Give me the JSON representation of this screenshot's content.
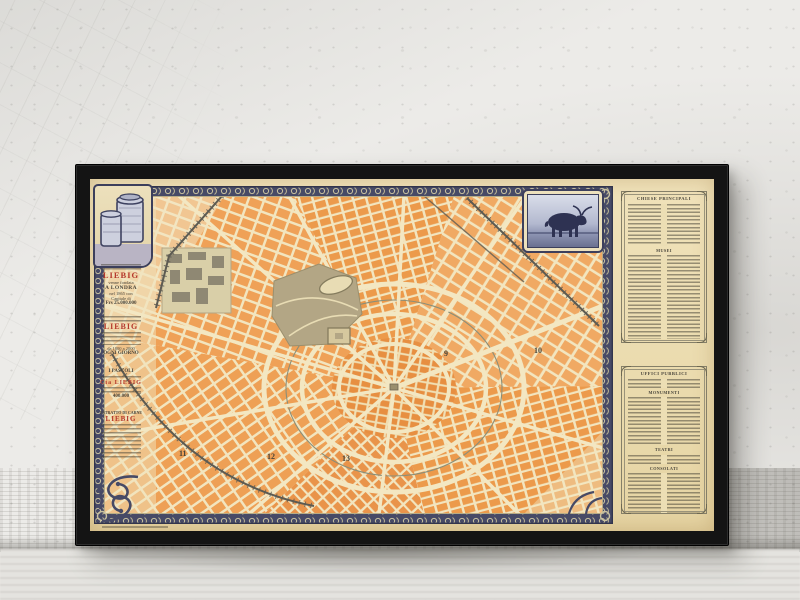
{
  "colors": {
    "wall": "#ecebe8",
    "frame": "#141414",
    "sheet": "#eadcb2",
    "map_cream": "#f2e5bf",
    "block_orange": "#efa157",
    "block_orange_dark": "#e78f41",
    "border_indigo": "#474a66",
    "accent_red": "#b5392c",
    "park_green": "#b3a685"
  },
  "map": {
    "district_numbers": [
      "9",
      "10",
      "11",
      "12",
      "13"
    ],
    "ads": {
      "block1": {
        "brand": "LIEBIG",
        "line1": "venne fondata",
        "line2": "A LONDRA",
        "line3": "nel 1865 con",
        "line4": "Capitale di",
        "line5": "Frs 25.000.000"
      },
      "block2": {
        "brand": "LIEBIG",
        "line1": "da 1800 a 2000",
        "footer": "OGNI GIORNO"
      },
      "block3": {
        "title": "I PASCOLI",
        "brand": "Cía LIEBIG",
        "value": "400.000"
      },
      "block4": {
        "header": "ESTRATTO DI CARNE",
        "brand": "LIEBIG"
      }
    },
    "index_panels": [
      {
        "title": "CHIESE PRINCIPALI",
        "sections": [
          "MUSEI"
        ]
      },
      {
        "title": "UFFICI PUBBLICI",
        "sections": [
          "MONUMENTI",
          "TEATRI",
          "CONSOLATI"
        ]
      }
    ]
  }
}
